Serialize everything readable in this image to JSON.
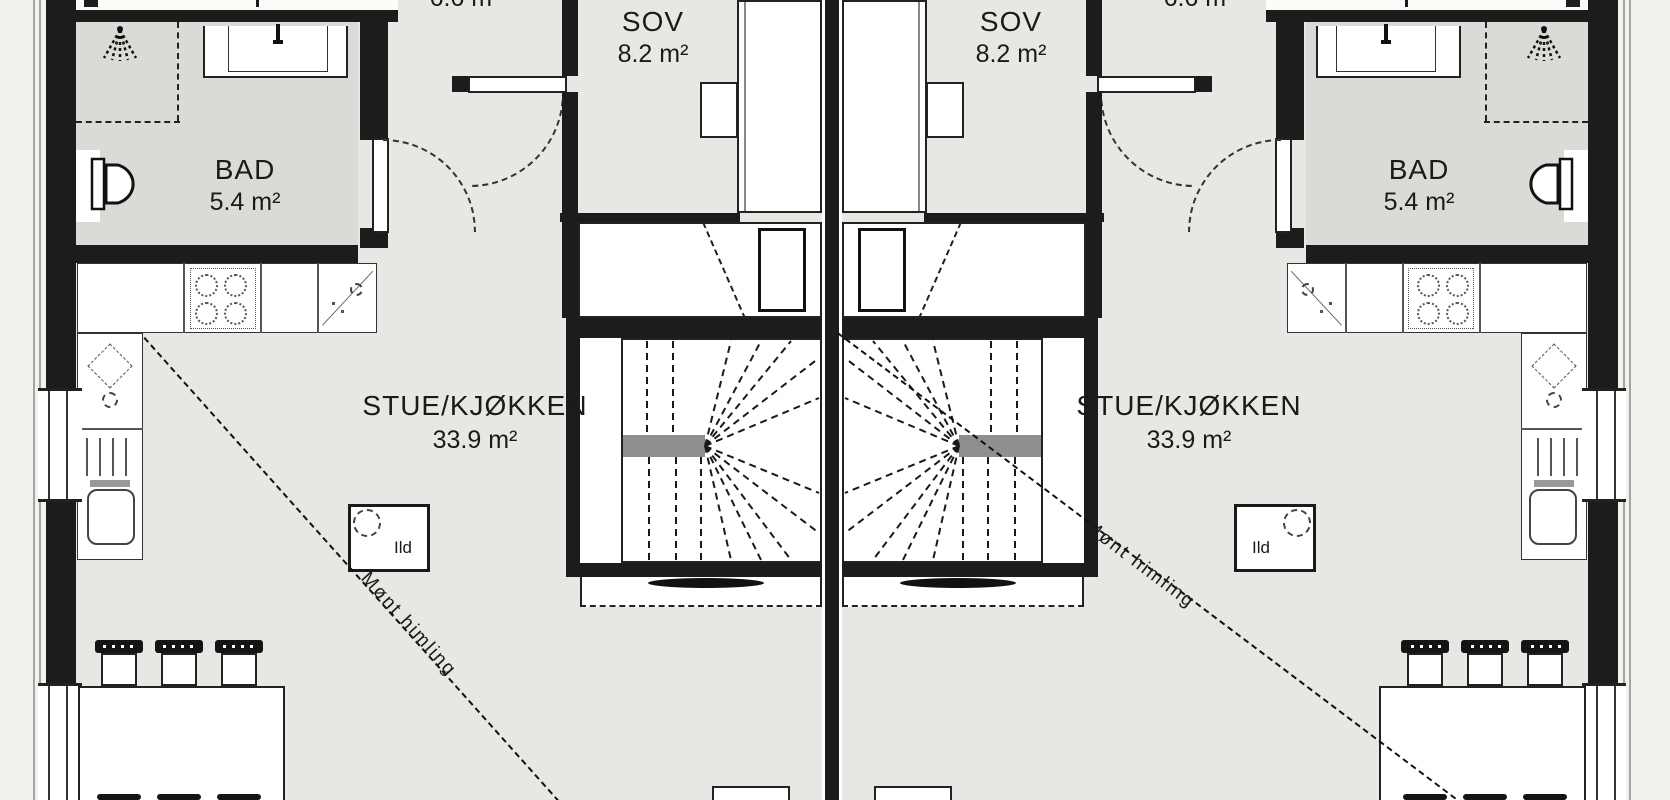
{
  "meta": {
    "drawing_type": "floor plan",
    "language": "Norwegian"
  },
  "colors": {
    "background": "#f2f1ed",
    "floor": "#e8e7e3",
    "bath_floor": "#dbdad7",
    "wall": "#1c1c1c",
    "furniture": "#ffffff",
    "stair_landing": "#8f8f8f"
  },
  "rooms": {
    "bad": {
      "name": "BAD",
      "area": "5.4 m²"
    },
    "sov": {
      "name": "SOV",
      "area": "8.2 m²"
    },
    "stue": {
      "name": "STUE/KJØKKEN",
      "area": "33.9 m²"
    },
    "top_partial": {
      "area": "6.6 m²"
    }
  },
  "annotations": {
    "fireplace": "Ild",
    "ceiling": "Mønt himling"
  }
}
